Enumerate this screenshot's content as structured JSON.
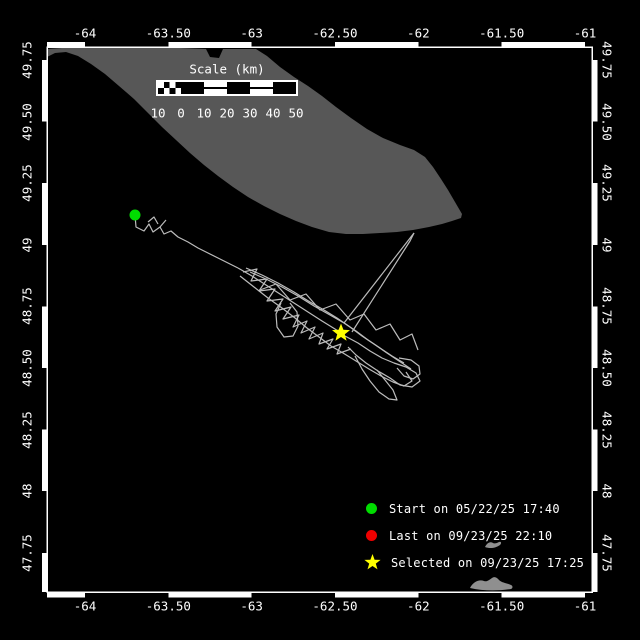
{
  "window": {
    "width": 640,
    "height": 640,
    "background": "#000000"
  },
  "colors": {
    "frame": "#ffffff",
    "text": "#ffffff",
    "island": "#575757",
    "track": "#bcbcbc",
    "start": "#00dc00",
    "last": "#ee0000",
    "selected": "#ffff00",
    "whale": "#8f8f8f"
  },
  "axes": {
    "top_labels": [
      "-64",
      "-63.50",
      "-63",
      "-62.50",
      "-62",
      "-61.50",
      "-61"
    ],
    "bottom_labels": [
      "-64",
      "-63.50",
      "-63",
      "-62.50",
      "-62",
      "-61.50",
      "-61"
    ],
    "left_labels": [
      "49.75",
      "49.50",
      "49.25",
      "49",
      "48.75",
      "48.50",
      "48.25",
      "48",
      "47.75"
    ],
    "right_labels": [
      "49.75",
      "49.50",
      "49.25",
      "49",
      "48.75",
      "48.50",
      "48.25",
      "48",
      "47.75"
    ]
  },
  "scalebar": {
    "title": "Scale (km)",
    "tick_labels": [
      "10",
      "0",
      "10",
      "20",
      "30",
      "40",
      "50"
    ]
  },
  "legend": {
    "items": [
      {
        "marker": "circle",
        "color_key": "start",
        "label": "Start on 05/22/25 17:40"
      },
      {
        "marker": "circle",
        "color_key": "last",
        "label": "Last on 09/23/25 22:10"
      },
      {
        "marker": "star",
        "color_key": "selected",
        "label": "Selected on 09/23/25 17:25"
      }
    ]
  },
  "map": {
    "island_outline": [
      [
        47,
        49
      ],
      [
        62,
        48
      ],
      [
        120,
        48
      ],
      [
        180,
        48
      ],
      [
        206,
        49
      ],
      [
        210,
        57
      ],
      [
        219,
        58
      ],
      [
        223,
        49
      ],
      [
        256,
        49
      ],
      [
        267,
        56
      ],
      [
        280,
        67
      ],
      [
        294,
        77
      ],
      [
        308,
        86
      ],
      [
        322,
        96
      ],
      [
        336,
        107
      ],
      [
        351,
        118
      ],
      [
        367,
        129
      ],
      [
        383,
        138
      ],
      [
        400,
        145
      ],
      [
        414,
        150
      ],
      [
        425,
        157
      ],
      [
        433,
        167
      ],
      [
        441,
        179
      ],
      [
        448,
        190
      ],
      [
        455,
        202
      ],
      [
        462,
        214
      ],
      [
        461,
        218
      ],
      [
        452,
        221
      ],
      [
        442,
        224
      ],
      [
        429,
        227
      ],
      [
        413,
        230
      ],
      [
        397,
        232
      ],
      [
        380,
        233
      ],
      [
        363,
        234
      ],
      [
        346,
        234
      ],
      [
        329,
        232
      ],
      [
        312,
        227
      ],
      [
        296,
        221
      ],
      [
        280,
        214
      ],
      [
        264,
        206
      ],
      [
        248,
        197
      ],
      [
        233,
        187
      ],
      [
        218,
        176
      ],
      [
        204,
        165
      ],
      [
        190,
        153
      ],
      [
        176,
        140
      ],
      [
        162,
        127
      ],
      [
        148,
        113
      ],
      [
        134,
        99
      ],
      [
        119,
        86
      ],
      [
        105,
        74
      ],
      [
        91,
        64
      ],
      [
        78,
        56
      ],
      [
        66,
        52
      ],
      [
        55,
        53
      ],
      [
        47,
        57
      ]
    ],
    "track_polylines": [
      [
        [
          135,
          215
        ],
        [
          136,
          227
        ],
        [
          144,
          231
        ],
        [
          149,
          224
        ],
        [
          153,
          232
        ],
        [
          160,
          227
        ],
        [
          164,
          234
        ],
        [
          171,
          231
        ],
        [
          178,
          237
        ],
        [
          188,
          242
        ],
        [
          198,
          248
        ],
        [
          208,
          253
        ],
        [
          218,
          258
        ],
        [
          228,
          263
        ],
        [
          238,
          268
        ]
      ],
      [
        [
          148,
          222
        ],
        [
          154,
          217
        ],
        [
          158,
          224
        ]
      ],
      [
        [
          160,
          227
        ],
        [
          166,
          220
        ]
      ],
      [
        [
          238,
          268
        ],
        [
          252,
          276
        ],
        [
          266,
          285
        ],
        [
          280,
          294
        ],
        [
          294,
          303
        ],
        [
          308,
          312
        ],
        [
          322,
          321
        ],
        [
          335,
          329
        ],
        [
          341,
          333
        ]
      ],
      [
        [
          246,
          268
        ],
        [
          262,
          275
        ],
        [
          278,
          283
        ],
        [
          294,
          292
        ],
        [
          310,
          302
        ],
        [
          324,
          310
        ],
        [
          337,
          318
        ],
        [
          350,
          327
        ],
        [
          362,
          336
        ],
        [
          374,
          344
        ],
        [
          387,
          353
        ],
        [
          399,
          361
        ],
        [
          411,
          369
        ]
      ],
      [
        [
          240,
          276
        ],
        [
          254,
          287
        ],
        [
          268,
          298
        ],
        [
          282,
          308
        ],
        [
          295,
          318
        ],
        [
          307,
          328
        ],
        [
          319,
          337
        ],
        [
          331,
          346
        ],
        [
          343,
          353
        ],
        [
          356,
          361
        ],
        [
          369,
          369
        ],
        [
          381,
          376
        ],
        [
          393,
          382
        ],
        [
          404,
          386
        ],
        [
          412,
          381
        ],
        [
          406,
          372
        ]
      ],
      [
        [
          243,
          272
        ],
        [
          257,
          269
        ],
        [
          251,
          281
        ],
        [
          267,
          279
        ],
        [
          259,
          291
        ],
        [
          275,
          289
        ],
        [
          267,
          301
        ],
        [
          283,
          299
        ],
        [
          275,
          311
        ],
        [
          291,
          307
        ],
        [
          283,
          319
        ],
        [
          299,
          315
        ],
        [
          293,
          327
        ],
        [
          307,
          321
        ],
        [
          301,
          333
        ],
        [
          315,
          327
        ],
        [
          309,
          339
        ],
        [
          323,
          333
        ],
        [
          319,
          344
        ],
        [
          333,
          339
        ],
        [
          327,
          349
        ],
        [
          341,
          344
        ],
        [
          337,
          354
        ],
        [
          351,
          349
        ]
      ],
      [
        [
          281,
          303
        ],
        [
          276,
          314
        ],
        [
          277,
          327
        ],
        [
          284,
          337
        ],
        [
          293,
          336
        ],
        [
          298,
          326
        ],
        [
          297,
          312
        ],
        [
          290,
          303
        ]
      ],
      [
        [
          345,
          336
        ],
        [
          358,
          343
        ],
        [
          370,
          351
        ],
        [
          382,
          358
        ],
        [
          394,
          363
        ],
        [
          406,
          367
        ],
        [
          416,
          373
        ],
        [
          420,
          381
        ],
        [
          412,
          387
        ],
        [
          400,
          385
        ],
        [
          390,
          378
        ],
        [
          378,
          371
        ],
        [
          366,
          363
        ],
        [
          356,
          355
        ],
        [
          348,
          347
        ]
      ],
      [
        [
          355,
          356
        ],
        [
          362,
          369
        ],
        [
          370,
          381
        ],
        [
          379,
          392
        ],
        [
          389,
          399
        ],
        [
          397,
          400
        ],
        [
          393,
          390
        ],
        [
          385,
          380
        ],
        [
          377,
          370
        ]
      ],
      [
        [
          399,
          358
        ],
        [
          411,
          360
        ],
        [
          419,
          366
        ],
        [
          420,
          374
        ],
        [
          413,
          379
        ],
        [
          404,
          376
        ],
        [
          397,
          368
        ]
      ],
      [
        [
          250,
          272
        ],
        [
          266,
          279
        ],
        [
          282,
          287
        ],
        [
          298,
          296
        ],
        [
          314,
          306
        ],
        [
          330,
          315
        ],
        [
          344,
          323
        ],
        [
          356,
          331
        ],
        [
          368,
          340
        ],
        [
          380,
          348
        ],
        [
          392,
          356
        ],
        [
          404,
          363
        ]
      ],
      [
        [
          260,
          290
        ],
        [
          276,
          284
        ],
        [
          290,
          300
        ],
        [
          306,
          294
        ],
        [
          320,
          310
        ],
        [
          336,
          304
        ],
        [
          350,
          320
        ],
        [
          364,
          314
        ],
        [
          376,
          330
        ],
        [
          390,
          324
        ],
        [
          400,
          340
        ],
        [
          412,
          334
        ],
        [
          418,
          350
        ]
      ],
      [
        [
          344,
          323
        ],
        [
          414,
          233
        ]
      ],
      [
        [
          352,
          332
        ],
        [
          410,
          241
        ],
        [
          414,
          233
        ]
      ]
    ],
    "markers": [
      {
        "type": "dot",
        "name": "start-marker",
        "x": 135,
        "y": 215,
        "color_key": "start"
      },
      {
        "type": "star",
        "name": "selected-marker",
        "x": 341,
        "y": 333,
        "color_key": "selected"
      }
    ],
    "whale_shapes": [
      "M485,547 c2,-4 5,-6 8,-4 c2,1 4,0 6,-1 c2,-1 3,1 1,3 c-4,3 -10,4 -15,2 z",
      "M470,588 c3,-6 9,-9 14,-7 c3,1 5,-1 8,-3 c3,-2 5,0 7,2 c3,3 8,3 12,5 c2,1 2,3 0,4 c-13,2 -28,2 -41,-1 z"
    ]
  }
}
